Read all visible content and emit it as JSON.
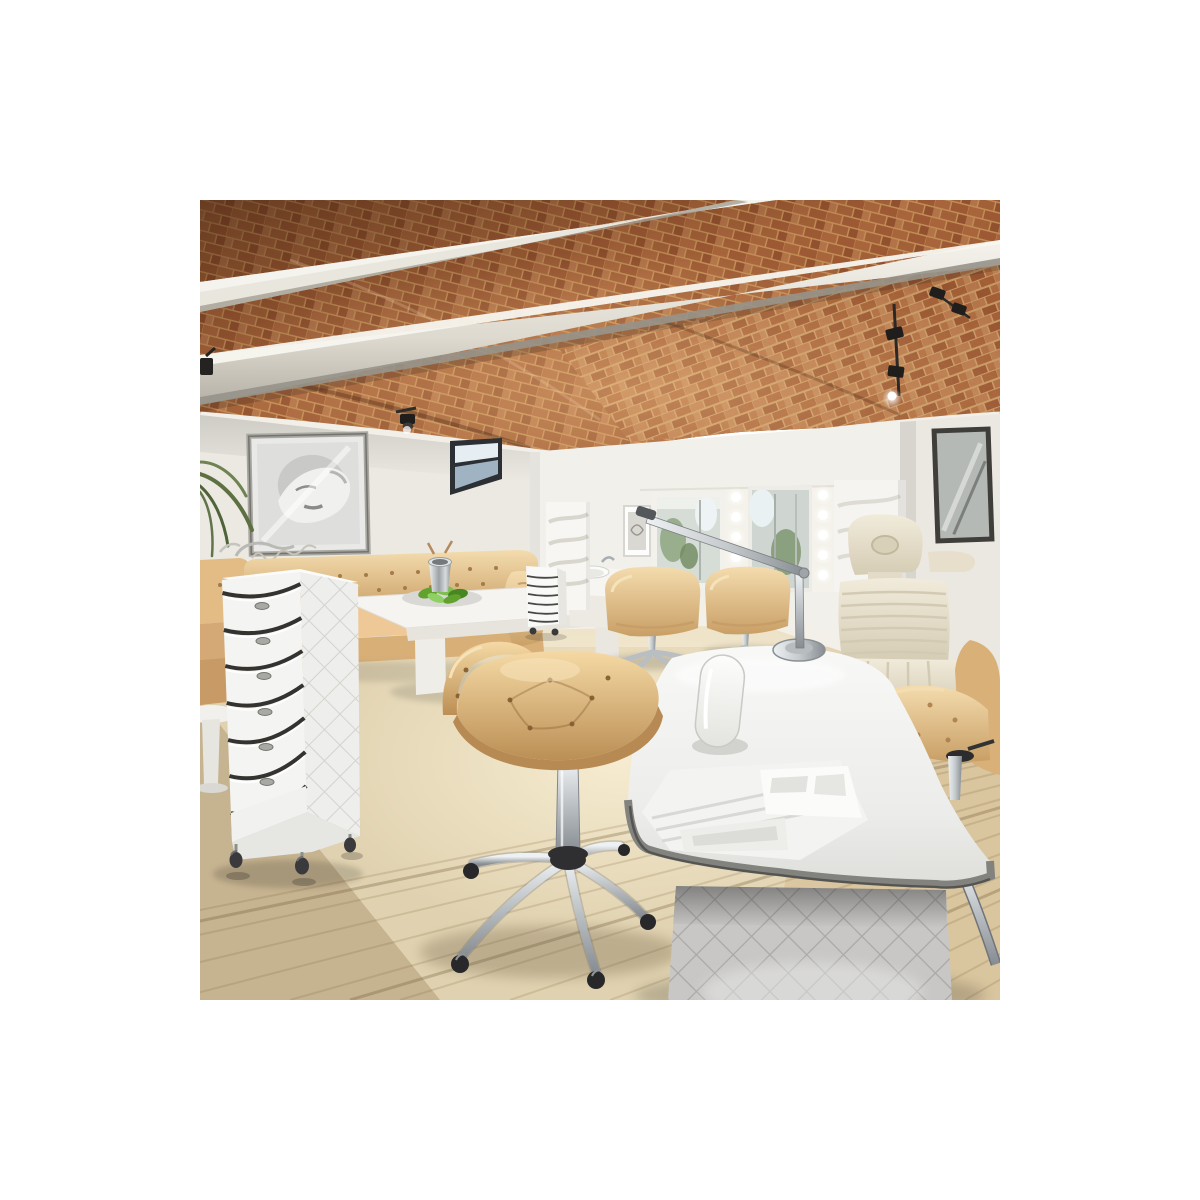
{
  "page": {
    "background": "#ffffff",
    "title": "Salon interior product photo"
  },
  "photo": {
    "alt": "Beauty salon interior with exposed brick vaulted ceiling, white steel beams, track spotlights, mirror stations with bulb lights, tan leather furniture, a white six-drawer salon trolley on casters, a tan tufted swivel stool and a white curved manicure table with a grey quilted base",
    "x": 200,
    "y": 200,
    "width": 800,
    "height": 800
  },
  "palette": {
    "border": "#ffffff",
    "brick": "#a8653c",
    "mortar": "#c49058",
    "beam": "#e9e6dd",
    "wall_left": "#ebe9e1",
    "wall_back": "#f2f0ea",
    "wall_right": "#eae8e0",
    "floor": "#e0d2b0",
    "leather_tan": "#e6c28e",
    "leather_gold": "#dfb87e",
    "cream_leather": "#ece5d3",
    "white_furniture": "#f8f8f6",
    "quilt_gray": "#c8c7c5",
    "chrome": "#c3c8cc",
    "glass": "#9fb3c2",
    "spotlight_black": "#1f1e1c",
    "greens": "#61a22e"
  },
  "objects": {
    "ceiling": "exposed brick herringbone vaulted ceiling",
    "beams": "two white steel beams",
    "lighting": "black track spotlights and hollywood mirror bulbs",
    "left_wall": "white wall with black and white portrait, small window and plant leaves",
    "stations": "mirror styling stations with gold tufted chairs",
    "treatment_chair": "cream ribbed beauty treatment chair",
    "lounge": "tan chesterfield sofa, white coffee table with salad bowl and ice bucket",
    "trolley": "white six-drawer salon trolley with quilted side panel on casters",
    "stool": "tan tufted swivel stool on chrome five-star base",
    "manicure_table": "white curved manicure table with armrest cushion, organizer trays, lamp and grey quilted pedestal"
  }
}
